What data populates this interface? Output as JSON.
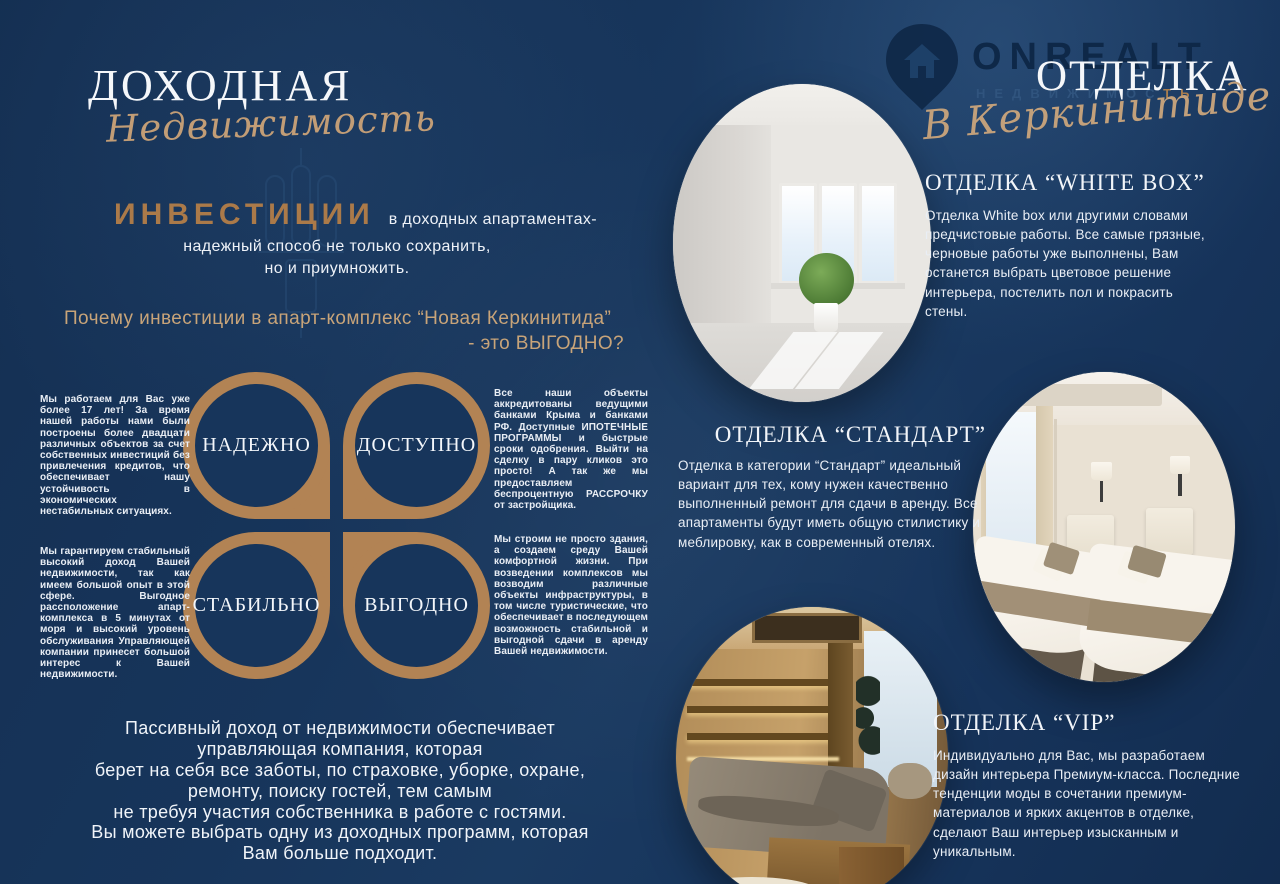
{
  "colors": {
    "background_navy": "#17355b",
    "ring_tan": "#b28354",
    "script_tan": "#c2a07b",
    "bronze": "#ab7a49",
    "heading_tan": "#c8a479",
    "text_white": "#f2f5f9"
  },
  "left": {
    "title": "ДОХОДНАЯ",
    "title_script": "Недвижимость",
    "invest": {
      "big": "ИНВЕСТИЦИИ",
      "tail": "в доходных апартаментах-",
      "line2": "надежный способ не только сохранить,",
      "line3": "но и приумножить."
    },
    "why": {
      "line1": "Почему инвестиции в апарт-комплекс “Новая Керкинитида”",
      "line2": "- это ВЫГОДНО?"
    },
    "circles": [
      {
        "label": "НАДЕЖНО"
      },
      {
        "label": "ДОСТУПНО"
      },
      {
        "label": "СТАБИЛЬНО"
      },
      {
        "label": "ВЫГОДНО"
      }
    ],
    "blocks": {
      "reliable": "Мы работаем для Вас уже более 17 лет! За время нашей работы нами были построены более двадцати различных объектов за счет собственных инвестиций без привлечения кредитов, что обеспечивает нашу устойчивость в экономических нестабильных ситуациях.",
      "accessible": "Все наши объекты аккредитованы ведущими банками Крыма и банками РФ. Доступные ИПОТЕЧНЫЕ ПРОГРАММЫ и быстрые сроки одобрения. Выйти на сделку в пару кликов это просто! А так же мы предоставляем беспроцентную РАССРОЧКУ от застройщика.",
      "stable": "Мы гарантируем стабильный высокий доход Вашей недвижимости, так как имеем большой опыт в этой сфере. Выгодное рассположение апарт-комплекса в 5 минутах от моря и высокий уровень обслуживания Управляющей компании принесет большой интерес к Вашей недвижимости.",
      "profitable": "Мы строим не просто здания, а создаем среду Вашей комфортной жизни. При возведении комплексов мы возводим различные объекты инфраструктуры, в том числе туристические, что обеспечивает в последующем возможность стабильной и выгодной сдачи в аренду Вашей недвижимости."
    },
    "footer_lines": [
      "Пассивный доход от недвижимости обеспечивает",
      "управляющая компания,  которая",
      "берет на себя все заботы, по страховке, уборке, охране,",
      "ремонту, поиску гостей, тем самым",
      "не требуя участия собственника в работе с гостями.",
      "Вы можете выбрать одну из доходных программ, которая",
      "Вам больше подходит."
    ]
  },
  "right": {
    "logo": {
      "name": "ONREALT",
      "subtitle": "НЕДВИЖИМОС",
      "subtitle_accent": "ТЬ"
    },
    "title": "ОТДЕЛКА",
    "title_script": "В Керкинитиде",
    "sections": [
      {
        "heading": "ОТДЕЛКА  “WHITE BOX”",
        "body": "Отделка White box или другими словами предчистовые работы. Все самые грязные, черновые работы уже выполнены, Вам останется выбрать цветовое решение интерьера, постелить пол и покрасить стены."
      },
      {
        "heading": "ОТДЕЛКА “СТАНДАРТ”",
        "body": "Отделка в категории “Стандарт” идеальный вариант для тех, кому нужен качественно выполненный ремонт для сдачи в аренду. Все апартаменты будут иметь общую стилистику и меблировку, как в современный отелях."
      },
      {
        "heading": "ОТДЕЛКА “VIP”",
        "body": "Индивидуально для Вас, мы разработаем дизайн интерьера Премиум-класса. Последние тенденции моды в сочетании премиум-материалов и ярких акцентов в отделке, сделают Ваш интерьер изысканным и уникальным."
      }
    ]
  }
}
